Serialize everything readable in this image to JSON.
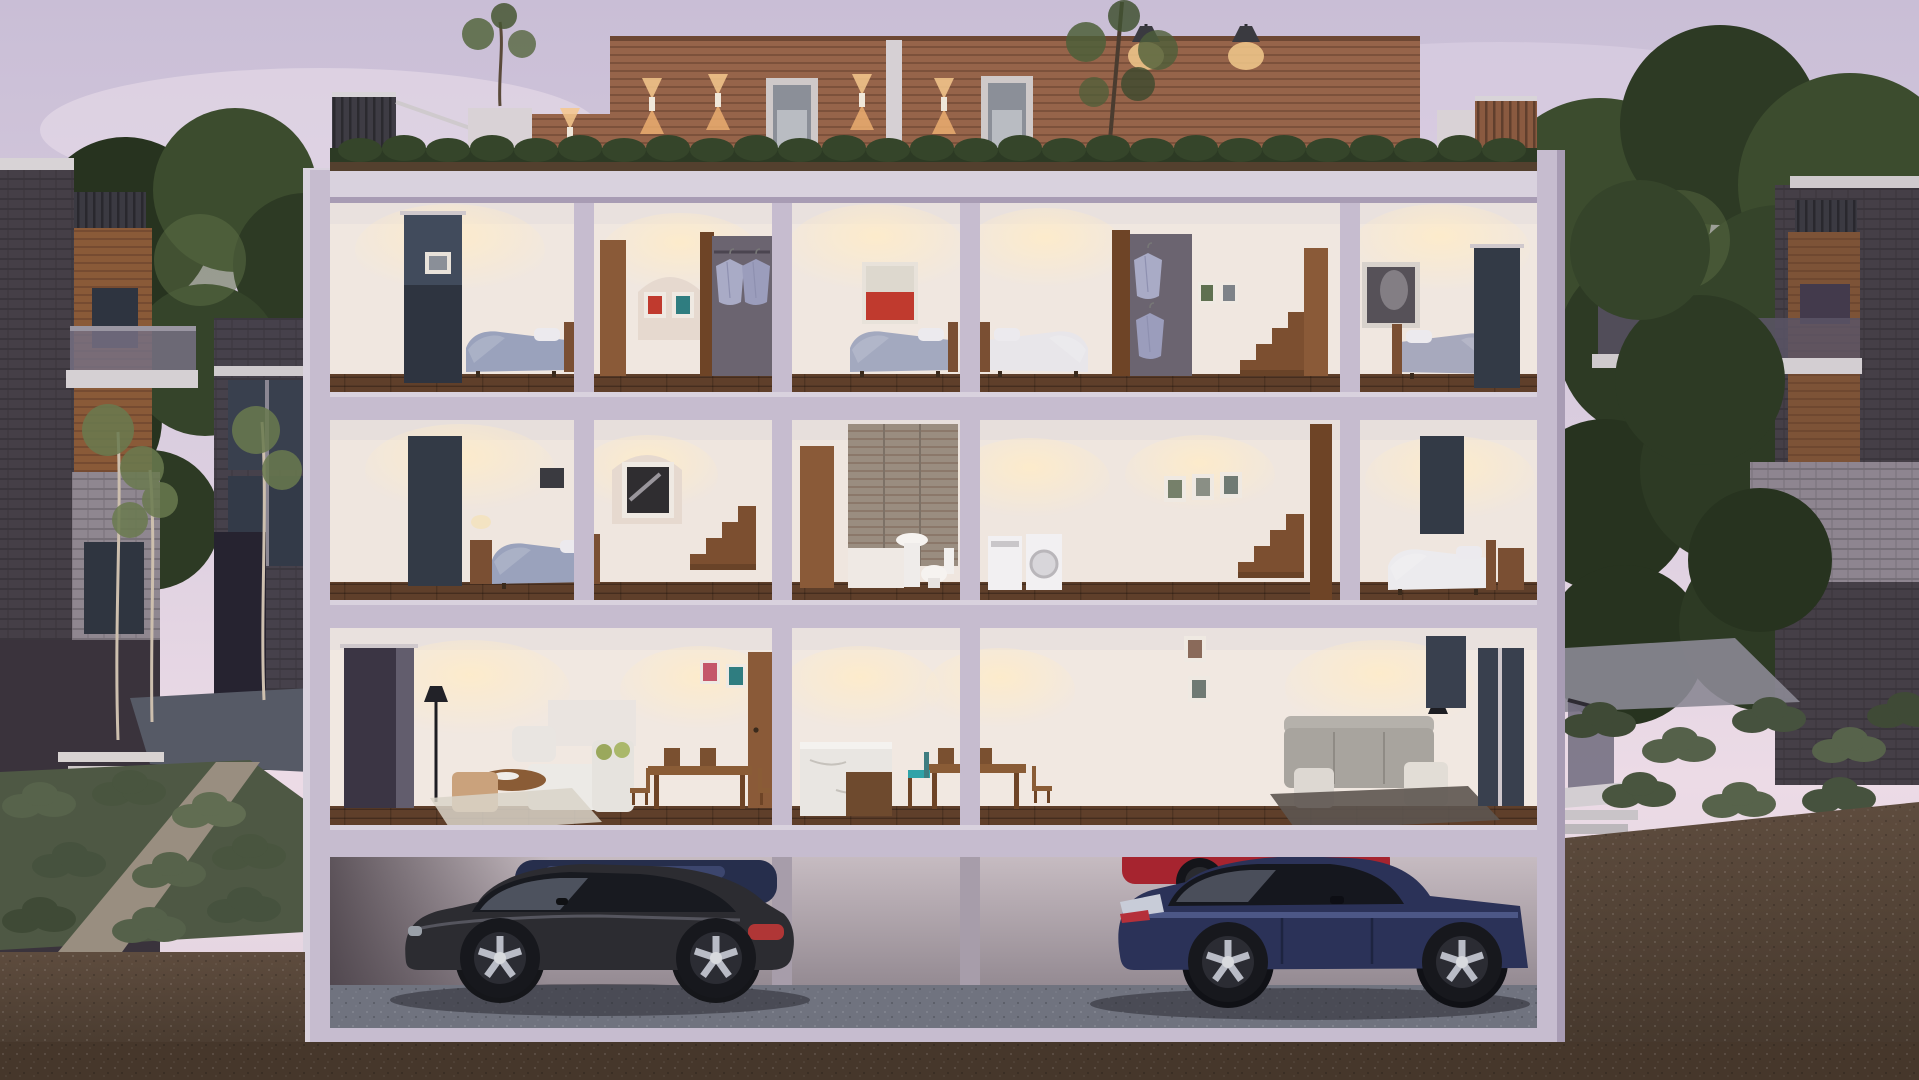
{
  "scene": {
    "type": "architectural-cutaway-rendering",
    "time_of_day": "dusk",
    "description": "Cross-section cutaway rendering of a three-storey townhouse block with roof terraces and a basement parking garage, flanked by neighbouring dark-brick townhouses, mature trees and landscaped shrub gardens under a lavender-pink dusk sky.",
    "palette": {
      "sky_top": "#c9bed6",
      "sky_pink": "#ecdbe6",
      "cloud": "#e7dcea",
      "slab": "#c6bccf",
      "slab_light": "#d9d2de",
      "slab_shadow": "#a89cb4",
      "wall_warm": "#f0e7e0",
      "wall_dim": "#ddd2d2",
      "ceiling": "#e9e1de",
      "floor_wood": "#5f3f2a",
      "wood": "#8a5a38",
      "wood_dark": "#6e4426",
      "penthouse_wood": "#96644a",
      "hedge": "#2c3a24",
      "tree_dark": "#27331f",
      "tree_mid": "#3c4c2e",
      "tree_light": "#5d6f45",
      "shrub_sage": "#57634b",
      "brick_dark": "#453f47",
      "brick_light": "#8f8790",
      "window_glass": "#39404e",
      "trim_white": "#d8d3d6",
      "paving": "#565a66",
      "gravel_path": "#998e80",
      "planter_black": "#202128",
      "soil": "#5b4938",
      "soil_dark": "#46372b",
      "garage_wall": "#bdb2b8",
      "garage_floor": "#70737f",
      "car_coupe": "#2c2c31",
      "car_blue": "#2b3258",
      "car_red": "#a6242f",
      "car_glass": "#181a20",
      "light_warm": "#f2c98c",
      "art_red": "#c03a2e",
      "accent_teal": "#2fa3a8",
      "bedding_lavender": "#9aa2bc",
      "bedding_white": "#ecebee",
      "sofa_white": "#eceae6",
      "sofa_grey": "#a8a49e",
      "marble": "#e9e6e2"
    },
    "building": {
      "roof": {
        "features": [
          "wood-clad penthouse with roof-deck doors",
          "up-down wall sconce lights",
          "pendant lights",
          "hedge planter boxes",
          "roof terraces with slat and glass railings",
          "small rooftop trees",
          "white service pillar"
        ]
      },
      "floors": [
        {
          "name": "top-floor",
          "rooms": [
            "bedroom with tall window and lavender bed",
            "closet hallway with twin art prints and hanging shirts",
            "bedroom with red abstract painting",
            "second bedroom with white bed",
            "walk-in closet with hanging shirts and stair",
            "bedroom with dark artwork and terrace window"
          ]
        },
        {
          "name": "middle-floor",
          "rooms": [
            "bedroom with bedside lamp",
            "hallway with framed monochrome print and stair",
            "bathroom with timber feature wall, basin and toilet",
            "laundry with washer and dryer",
            "stair hall with three framed photos",
            "bedroom with white duvet and timber nightstand"
          ]
        },
        {
          "name": "ground-floor",
          "rooms": [
            "living room with white sofa, armchairs and round coffee table",
            "dining room with timber table and chairs",
            "kitchen with marble island",
            "second dining area with teal and tan chairs",
            "living room with grey sofa, armchairs and black lamp"
          ]
        }
      ],
      "garage": {
        "name": "basement-parking",
        "vehicles": [
          {
            "name": "charcoal coupe",
            "color": "#2c2c31"
          },
          {
            "name": "navy sedan",
            "color": "#2b3258"
          },
          {
            "name": "red car behind sedan",
            "color": "#a6242f"
          },
          {
            "name": "dark blue car behind coupe",
            "color": "#262e4c"
          }
        ]
      }
    },
    "surroundings": {
      "left": [
        "dark brick townhouse with cedar panel and slat parapet",
        "glass balcony",
        "birch saplings",
        "sage shrub garden with gravel path",
        "black planter with sapling",
        "white garden steps"
      ],
      "right": [
        "brick townhouse with timber band and balconies",
        "large leafy trees",
        "glass balustrade with white steps",
        "shrub beds and paved walk"
      ],
      "sky": "lavender-pink dusk sky with soft clouds",
      "ground": "brown earth shown in cross-section below and beside the building"
    }
  }
}
